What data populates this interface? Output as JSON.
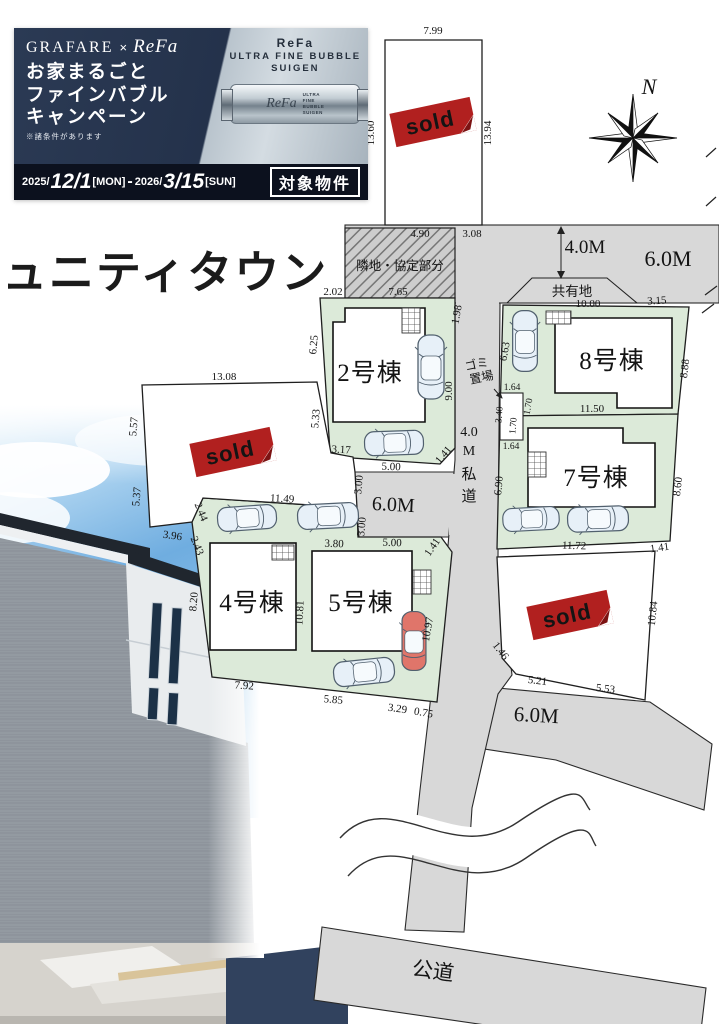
{
  "colors": {
    "sold_red": "#b1201f",
    "lot_green": "#dcead9",
    "road_gray": "#d8d8d8",
    "banner_navy": "#24324b",
    "banner_bottom_bg": "#0c111e"
  },
  "banner": {
    "brand_left": "GRAFARE",
    "brand_times": "×",
    "brand_right": "ReFa",
    "headline1": "お家まるごと",
    "headline2": "ファインバブル",
    "headline3": "キャンペーン",
    "note": "※諸条件があります",
    "product_name": "ReFa",
    "product_line2": "ULTRA FINE BUBBLE",
    "product_line3": "SUIGEN",
    "device_logo": "ReFa",
    "device_l1": "ULTRA",
    "device_l2": "FINE",
    "device_l3": "BUBBLE",
    "device_l4": "SUIGEN",
    "period_y1": "2025/",
    "period_d1": "12/1",
    "period_w1": "[MON]",
    "period_sep": "-",
    "period_y2": "2026/",
    "period_d2": "3/15",
    "period_w2": "[SUN]",
    "badge": "対象物件"
  },
  "site_name": "ュニティタウン",
  "compass": "N",
  "sold": "sold",
  "areas": {
    "neighbor": "隣地・協定部分",
    "shared": "共有地",
    "garbage1": "ゴミ",
    "garbage2": "置場",
    "public_road": "公道",
    "road_4m": "4.0M",
    "road_6m_top": "6.0M",
    "road_6m_mid": "6.0M",
    "road_6m_bottom": "6.0M",
    "pr1": "4.0",
    "pr2": "M",
    "pr3": "私",
    "pr4": "道"
  },
  "lot_names": {
    "lot2": "2号棟",
    "lot4": "4号棟",
    "lot5": "5号棟",
    "lot7": "7号棟",
    "lot8": "8号棟"
  },
  "dims": {
    "t_top": "7.99",
    "t_left": "13.60",
    "t_right": "13.94",
    "n_top": "4.90",
    "n_bottom": "7.65",
    "n_side": "2.02",
    "r_308": "3.08",
    "l2_198": "1.98",
    "l2_900": "9.00",
    "l2_625": "6.25",
    "l2_533": "5.33",
    "l2_317": "3.17",
    "l2_141a": "1.41",
    "l2_141b": "1.41",
    "m_500a": "5.00",
    "m_500b": "5.00",
    "m_300a": "3.00",
    "m_300b": "3.00",
    "g_164a": "1.64",
    "g_170a": "1.70",
    "g_340": "3.40",
    "g_170b": "1.70",
    "g_164b": "1.64",
    "l8_1000": "10.00",
    "l8_315": "3.15",
    "l8_663": "6.63",
    "l8_888": "8.88",
    "l8_1150": "11.50",
    "l7_690": "6.90",
    "l7_860": "8.60",
    "l7_1172": "11.72",
    "l7_141": "1.41",
    "s3_1084": "10.84",
    "s3_521": "5.21",
    "s3_553": "5.53",
    "s3_146": "1.46",
    "s2_1308": "13.08",
    "s2_557": "5.57",
    "s2_537": "5.37",
    "s2_396": "3.96",
    "s2_244": "2.44",
    "s2_243": "2.43",
    "l45_1149": "11.49",
    "l45_820": "8.20",
    "l45_792": "7.92",
    "l45_1081": "10.81",
    "l5_380": "3.80",
    "l45_585": "5.85",
    "l45_329": "3.29",
    "l45_075": "0.75",
    "l5_1097": "10.97"
  }
}
